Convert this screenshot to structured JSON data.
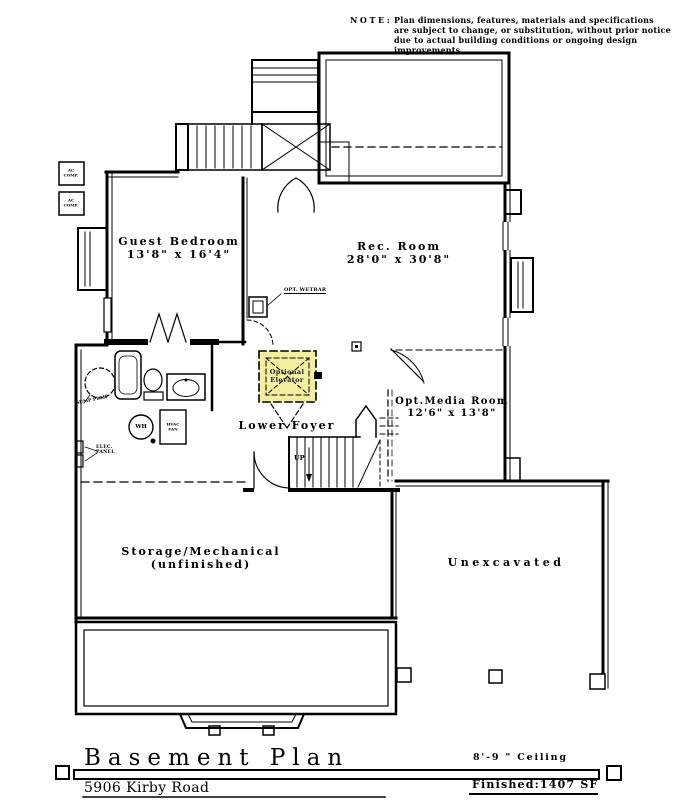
{
  "note": {
    "heading": "NOTE:",
    "lines": [
      "Plan dimensions, features, materials and specifications",
      "are subject to change, or substitution, without prior notice",
      "due to actual building conditions or ongoing design improvements."
    ]
  },
  "rooms": {
    "guest_bedroom": {
      "name": "Guest Bedroom",
      "dims": "13'8\" x 16'4\""
    },
    "rec_room": {
      "name": "Rec. Room",
      "dims": "28'0\" x 30'8\""
    },
    "media_room": {
      "name": "Opt.Media Room",
      "dims": "12'6\" x 13'8\""
    },
    "lower_foyer": {
      "name": "Lower Foyer"
    },
    "storage": {
      "name": "Storage/Mechanical",
      "sub": "(unfinished)"
    },
    "unexcavated": {
      "name": "Unexcavated"
    }
  },
  "fixtures": {
    "elevator_line1": "Optional",
    "elevator_line2": "Elevator",
    "wetbar": "OPT. WETBAR",
    "sump": "SUMP PUMP",
    "elec_panel_line1": "ELEC.",
    "elec_panel_line2": "PANEL",
    "water_heater": "WH",
    "hvac_line1": "HVAC",
    "hvac_line2": "FAN",
    "stairs_up": "UP",
    "ac_line1": "AC",
    "ac_line2": "COMP."
  },
  "title_block": {
    "title": "Basement Plan",
    "address": "5906 Kirby Road",
    "ceiling": "8'-9 \" Ceiling",
    "finished": "Finished:1407 SF"
  },
  "colors": {
    "elevator_highlight": "#f2efa0",
    "line": "#000000",
    "background": "#ffffff"
  }
}
